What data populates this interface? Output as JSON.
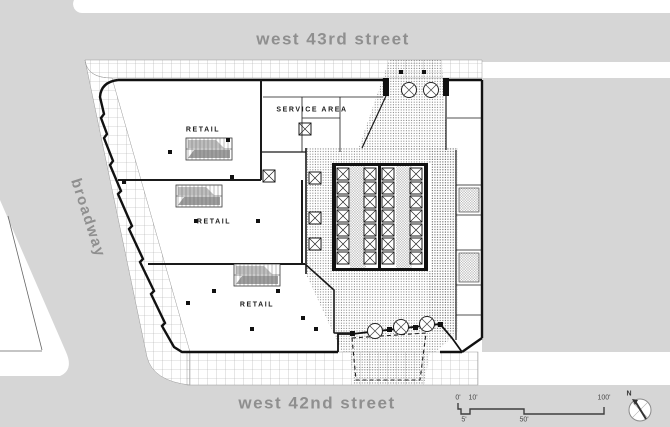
{
  "streets": {
    "north": "west 43rd street",
    "south": "west 42nd street",
    "west": "broadway"
  },
  "plan_labels": {
    "retail_upper": "RETAIL",
    "retail_middle": "RETAIL",
    "retail_lower": "RETAIL",
    "service_area": "SERVICE AREA"
  },
  "scale_bar": {
    "ticks_top": [
      "0'",
      "10'",
      "100'"
    ],
    "ticks_bottom": [
      "5'",
      "50'"
    ]
  },
  "compass": {
    "north": "N"
  },
  "colors": {
    "street_fill": "#d6d6d6",
    "street_text": "#8f8f8f",
    "plan_line": "#1a1a1a",
    "sidewalk_grid_line": "#ababab",
    "carpet_dot": "#6f6f6f"
  }
}
